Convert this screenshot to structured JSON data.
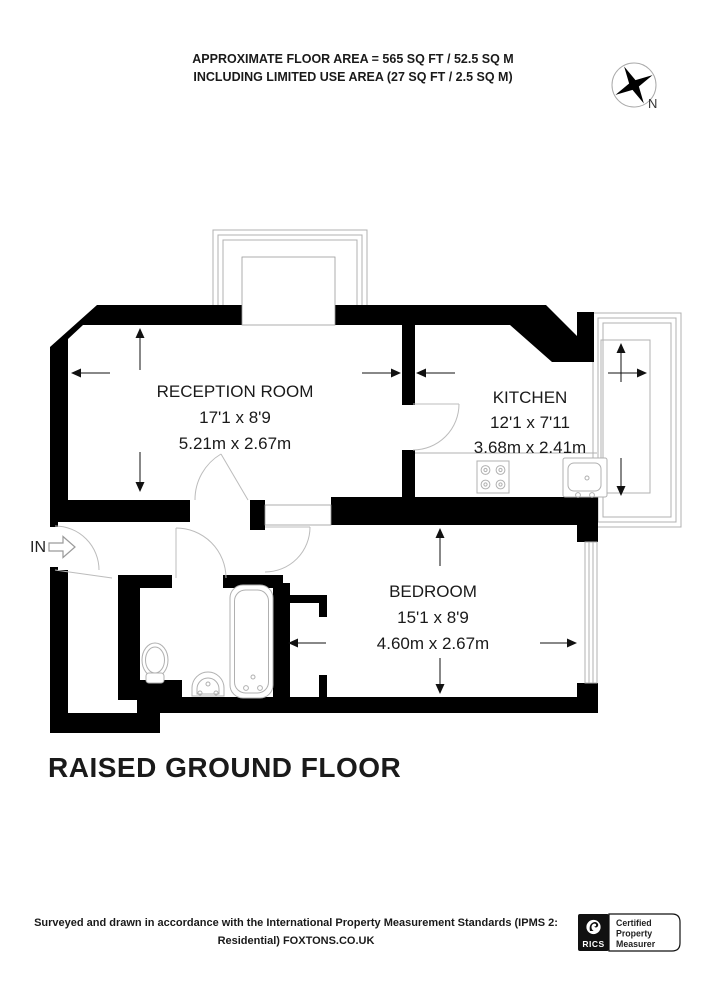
{
  "header": {
    "area_line1": "APPROXIMATE FLOOR AREA = 565 SQ FT / 52.5 SQ M",
    "area_line2": "INCLUDING LIMITED USE AREA (27 SQ FT / 2.5 SQ M)",
    "compass_label": "N"
  },
  "rooms": [
    {
      "name": "RECEPTION ROOM",
      "imperial": "17'1 x 8'9",
      "metric": "5.21m x 2.67m"
    },
    {
      "name": "KITCHEN",
      "imperial": "12'1 x 7'11",
      "metric": "3.68m x 2.41m"
    },
    {
      "name": "BEDROOM",
      "imperial": "15'1 x 8'9",
      "metric": "4.60m x 2.67m"
    }
  ],
  "entrance_label": "IN",
  "floor_title": "RAISED GROUND FLOOR",
  "footer": {
    "line1": "Surveyed and drawn in accordance with the International Property Measurement Standards (IPMS 2:",
    "line2": "Residential) FOXTONS.CO.UK",
    "badge": {
      "org": "RICS",
      "cert_lines": [
        "Certified",
        "Property",
        "Measurer"
      ]
    }
  },
  "colors": {
    "wall": "#000000",
    "thin_line": "#b0b0b0",
    "text": "#1a1a1a"
  }
}
